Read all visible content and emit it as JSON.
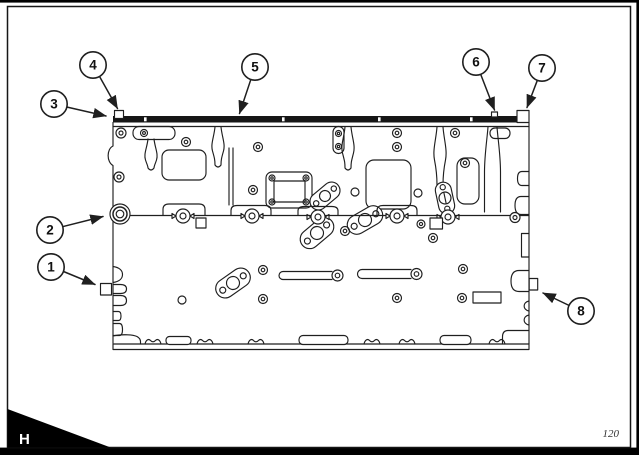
{
  "page": {
    "section_tab_label": "H",
    "page_number": "120"
  },
  "figure": {
    "callouts": [
      {
        "label": "1"
      },
      {
        "label": "2"
      },
      {
        "label": "3"
      },
      {
        "label": "4"
      },
      {
        "label": "5"
      },
      {
        "label": "6"
      },
      {
        "label": "7"
      },
      {
        "label": "8"
      }
    ]
  },
  "colors": {
    "ink": "#1f1f1f",
    "paper": "#ffffff",
    "frame": "#000000"
  }
}
